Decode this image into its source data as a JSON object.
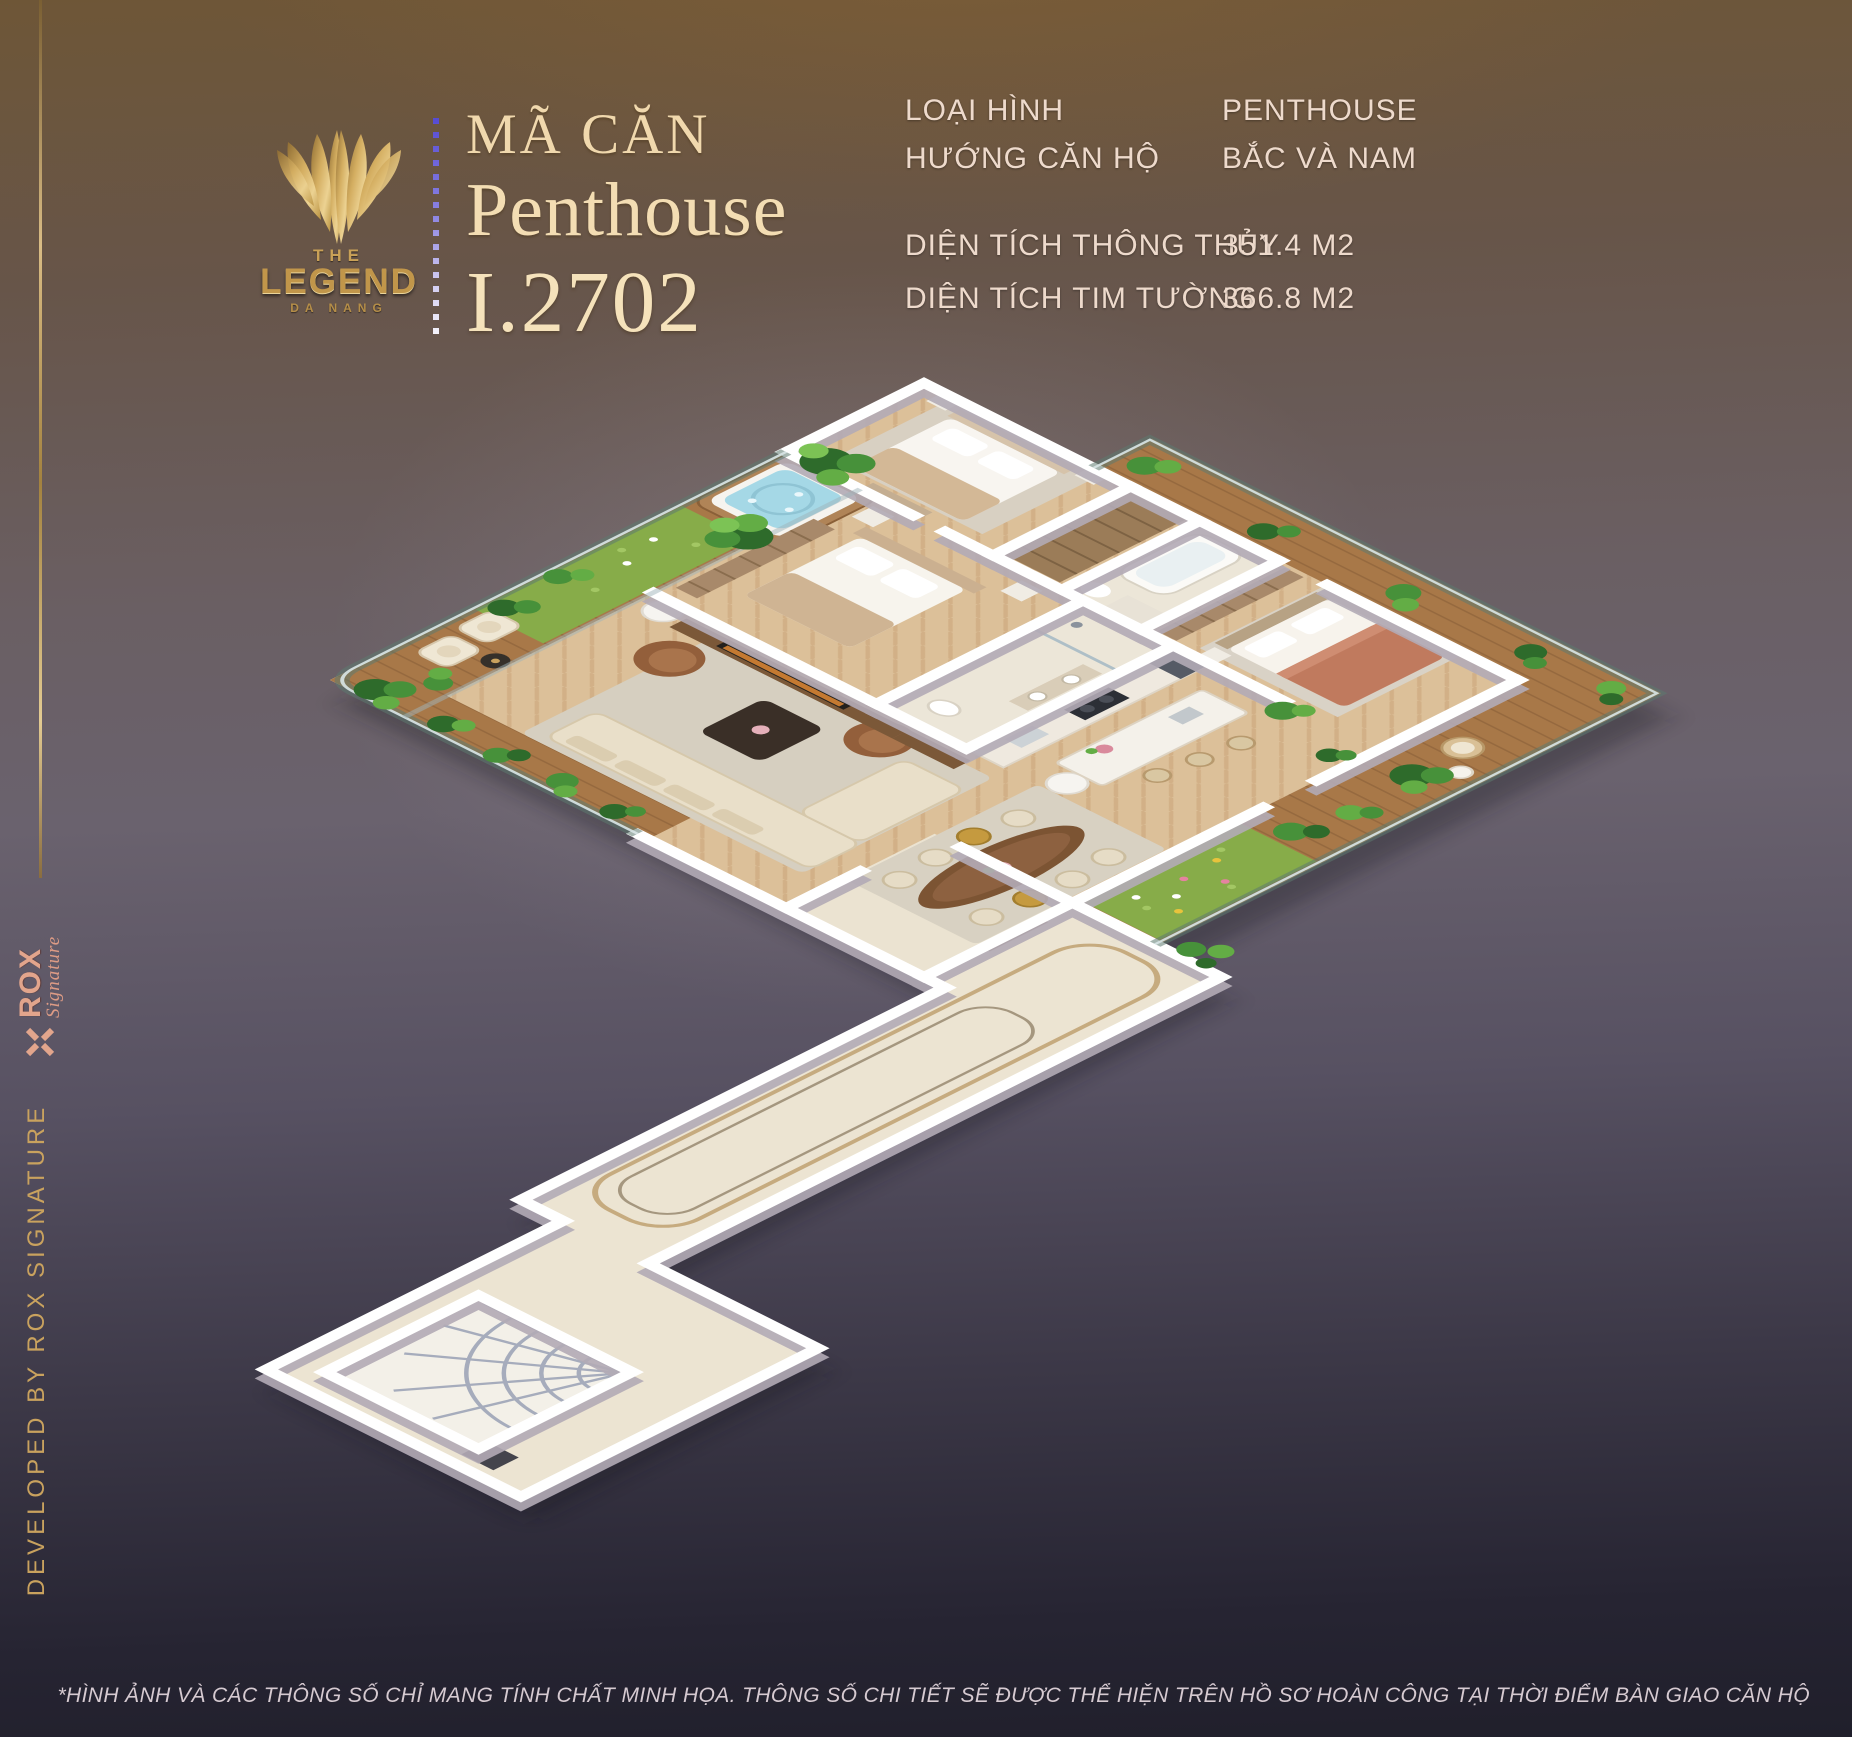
{
  "brand": {
    "the": "THE",
    "name": "LEGEND",
    "city": "DA NANG"
  },
  "title": {
    "label": "MÃ CĂN",
    "type": "Penthouse",
    "code": "I.2702"
  },
  "specs": [
    {
      "label": "LOẠI HÌNH",
      "value": "PENTHOUSE"
    },
    {
      "label": "HƯỚNG CĂN HỘ",
      "value": "BẮC VÀ NAM"
    },
    {
      "label": "DIỆN TÍCH THÔNG THỦY",
      "value": "351.4 M2"
    },
    {
      "label": "DIỆN TÍCH TIM TƯỜNG",
      "value": "366.8 M2"
    }
  ],
  "sidebar": {
    "logo_text": "ROX",
    "logo_sub": "Signature",
    "credit": "DEVELOPED BY ROX SIGNATURE"
  },
  "footer": {
    "disclaimer": "*HÌNH ẢNH VÀ CÁC THÔNG SỐ CHỈ MANG TÍNH CHẤT MINH HỌA. THÔNG SỐ CHI TIẾT SẼ ĐƯỢC THỂ HIỆN TRÊN HỒ SƠ HOÀN CÔNG TẠI THỜI ĐIỂM BÀN GIAO CĂN HỘ"
  },
  "colors": {
    "accent_gold": "#d4af6a",
    "title_cream": "#f3ddb3",
    "rox_rose": "#e2a58c",
    "divider_purple": "#6a5cd8",
    "background_top": "#6e5637",
    "background_bottom": "#201f2b",
    "wood_floor": "#dcc099",
    "deck_wood": "#a87848",
    "grass": "#87ac49",
    "wall_white": "#ffffff",
    "glass": "#5d7a70"
  }
}
